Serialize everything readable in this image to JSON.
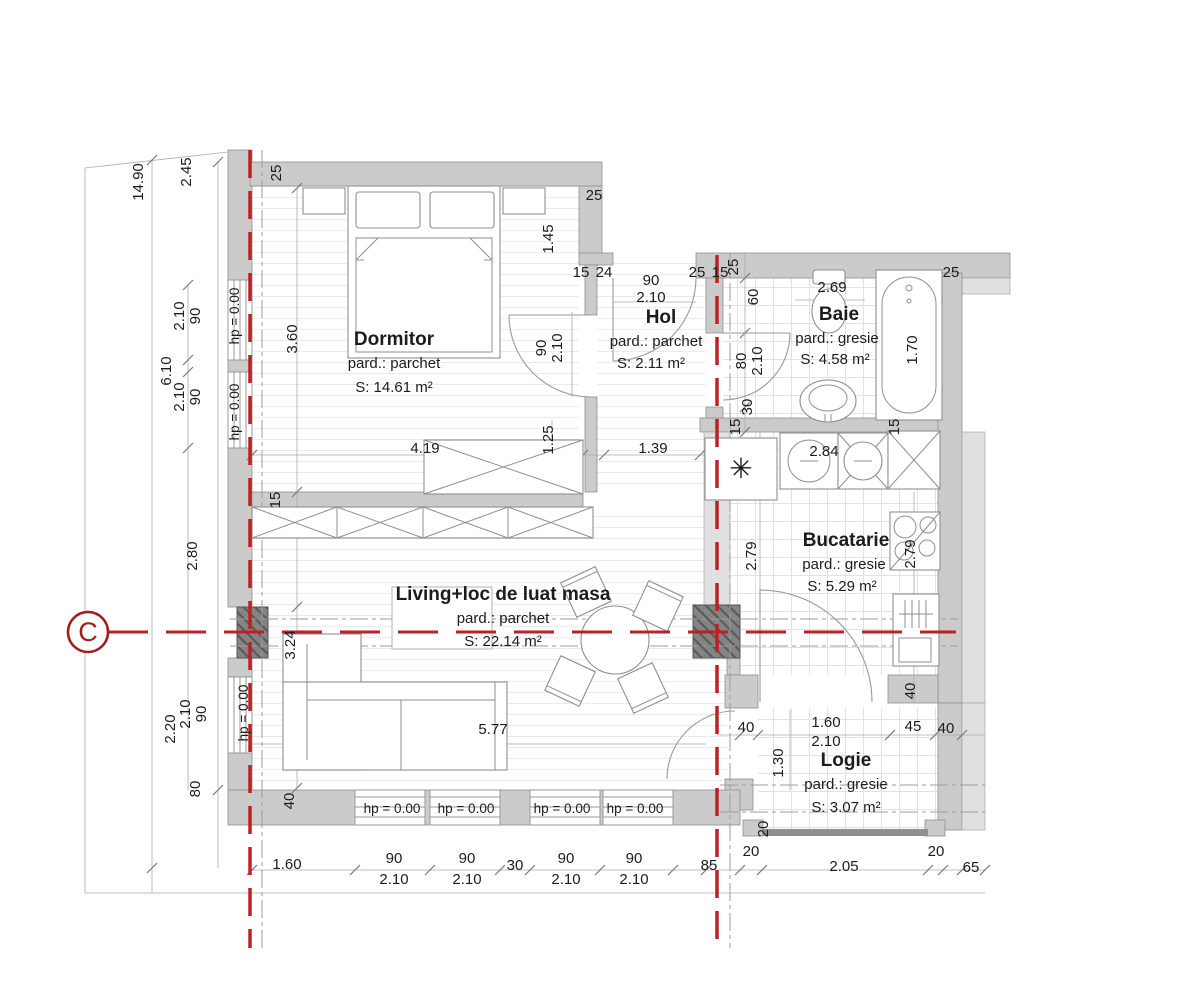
{
  "drawing": {
    "kind": "apartment-floor-plan",
    "section_marker": {
      "label": "C"
    },
    "colors": {
      "section_red": "#bf2026",
      "marker_red": "#a21d1d",
      "wall_gray": "#cbcbcb",
      "column_dark": "#848484"
    }
  },
  "rooms": [
    {
      "id": "dormitor",
      "name": "Dormitor",
      "floor": "pard.: parchet",
      "area": "S: 14.61 m²"
    },
    {
      "id": "hol",
      "name": "Hol",
      "floor": "pard.: parchet",
      "area": "S: 2.11 m²"
    },
    {
      "id": "baie",
      "name": "Baie",
      "floor": "pard.: gresie",
      "area": "S: 4.58 m²"
    },
    {
      "id": "bucatarie",
      "name": "Bucatarie",
      "floor": "pard.: gresie",
      "area": "S: 5.29 m²"
    },
    {
      "id": "living",
      "name": "Living+loc de luat masa",
      "floor": "pard.: parchet",
      "area": "S: 22.14 m²"
    },
    {
      "id": "logie",
      "name": "Logie",
      "floor": "pard.: gresie",
      "area": "S: 3.07 m²"
    }
  ],
  "dimensions": [
    {
      "t": "14.90",
      "x": 143,
      "y": 182,
      "r": -90
    },
    {
      "t": "2.45",
      "x": 191,
      "y": 172,
      "r": -90
    },
    {
      "t": "90",
      "x": 200,
      "y": 316,
      "r": -90
    },
    {
      "t": "2.10",
      "x": 184,
      "y": 316,
      "r": -90
    },
    {
      "t": "hp = 0.00",
      "x": 239,
      "y": 316,
      "r": -90,
      "s": true
    },
    {
      "t": "6.10",
      "x": 171,
      "y": 371,
      "r": -90
    },
    {
      "t": "90",
      "x": 200,
      "y": 397,
      "r": -90
    },
    {
      "t": "2.10",
      "x": 184,
      "y": 397,
      "r": -90
    },
    {
      "t": "hp = 0.00",
      "x": 239,
      "y": 412,
      "r": -90,
      "s": true
    },
    {
      "t": "2.80",
      "x": 197,
      "y": 556,
      "r": -90
    },
    {
      "t": "90",
      "x": 206,
      "y": 714,
      "r": -90
    },
    {
      "t": "2.10",
      "x": 190,
      "y": 714,
      "r": -90
    },
    {
      "t": "2.20",
      "x": 175,
      "y": 729,
      "r": -90
    },
    {
      "t": "hp = 0.00",
      "x": 248,
      "y": 713,
      "r": -90,
      "s": true
    },
    {
      "t": "80",
      "x": 200,
      "y": 789,
      "r": -90
    },
    {
      "t": "25",
      "x": 281,
      "y": 173,
      "r": -90
    },
    {
      "t": "3.60",
      "x": 297,
      "y": 339,
      "r": -90
    },
    {
      "t": "15",
      "x": 280,
      "y": 500,
      "r": -90
    },
    {
      "t": "3.24",
      "x": 295,
      "y": 645,
      "r": -90
    },
    {
      "t": "40",
      "x": 294,
      "y": 801,
      "r": -90
    },
    {
      "t": "25",
      "x": 594,
      "y": 200
    },
    {
      "t": "1.45",
      "x": 553,
      "y": 239,
      "r": -90
    },
    {
      "t": "15",
      "x": 581,
      "y": 277
    },
    {
      "t": "24",
      "x": 604,
      "y": 277
    },
    {
      "t": "90",
      "x": 651,
      "y": 285
    },
    {
      "t": "2.10",
      "x": 651,
      "y": 302
    },
    {
      "t": "25",
      "x": 697,
      "y": 277
    },
    {
      "t": "15",
      "x": 720,
      "y": 277
    },
    {
      "t": "25",
      "x": 738,
      "y": 267,
      "r": -90
    },
    {
      "t": "60",
      "x": 758,
      "y": 297,
      "r": -90
    },
    {
      "t": "80",
      "x": 746,
      "y": 361,
      "r": -90
    },
    {
      "t": "2.10",
      "x": 762,
      "y": 361,
      "r": -90
    },
    {
      "t": "30",
      "x": 752,
      "y": 407,
      "r": -90
    },
    {
      "t": "15",
      "x": 740,
      "y": 427,
      "r": -90
    },
    {
      "t": "2.69",
      "x": 832,
      "y": 292
    },
    {
      "t": "1.70",
      "x": 917,
      "y": 350,
      "r": -90
    },
    {
      "t": "25",
      "x": 951,
      "y": 277
    },
    {
      "t": "15",
      "x": 899,
      "y": 427,
      "r": -90
    },
    {
      "t": "90",
      "x": 546,
      "y": 348,
      "r": -90
    },
    {
      "t": "2.10",
      "x": 562,
      "y": 348,
      "r": -90
    },
    {
      "t": "4.19",
      "x": 425,
      "y": 453
    },
    {
      "t": "1.25",
      "x": 553,
      "y": 440,
      "r": -90
    },
    {
      "t": "1.39",
      "x": 653,
      "y": 453
    },
    {
      "t": "2.84",
      "x": 824,
      "y": 456
    },
    {
      "t": "2.79",
      "x": 756,
      "y": 556,
      "r": -90
    },
    {
      "t": "2.79",
      "x": 915,
      "y": 554,
      "r": -90
    },
    {
      "t": "40",
      "x": 915,
      "y": 691,
      "r": -90
    },
    {
      "t": "5.77",
      "x": 493,
      "y": 734
    },
    {
      "t": "40",
      "x": 746,
      "y": 732
    },
    {
      "t": "1.60",
      "x": 826,
      "y": 727
    },
    {
      "t": "2.10",
      "x": 826,
      "y": 746
    },
    {
      "t": "45",
      "x": 913,
      "y": 731
    },
    {
      "t": "40",
      "x": 946,
      "y": 733
    },
    {
      "t": "1.30",
      "x": 783,
      "y": 763,
      "r": -90
    },
    {
      "t": "20",
      "x": 768,
      "y": 829,
      "r": -90
    },
    {
      "t": "hp = 0.00",
      "x": 392,
      "y": 813,
      "s": true
    },
    {
      "t": "hp = 0.00",
      "x": 466,
      "y": 813,
      "s": true
    },
    {
      "t": "hp = 0.00",
      "x": 562,
      "y": 813,
      "s": true
    },
    {
      "t": "hp = 0.00",
      "x": 635,
      "y": 813,
      "s": true
    },
    {
      "t": "1.60",
      "x": 287,
      "y": 869
    },
    {
      "t": "90",
      "x": 394,
      "y": 863
    },
    {
      "t": "2.10",
      "x": 394,
      "y": 884
    },
    {
      "t": "90",
      "x": 467,
      "y": 863
    },
    {
      "t": "2.10",
      "x": 467,
      "y": 884
    },
    {
      "t": "30",
      "x": 515,
      "y": 870
    },
    {
      "t": "90",
      "x": 566,
      "y": 863
    },
    {
      "t": "2.10",
      "x": 566,
      "y": 884
    },
    {
      "t": "90",
      "x": 634,
      "y": 863
    },
    {
      "t": "2.10",
      "x": 634,
      "y": 884
    },
    {
      "t": "85",
      "x": 709,
      "y": 870
    },
    {
      "t": "20",
      "x": 751,
      "y": 856
    },
    {
      "t": "2.05",
      "x": 844,
      "y": 871
    },
    {
      "t": "20",
      "x": 936,
      "y": 856
    },
    {
      "t": "65",
      "x": 971,
      "y": 872
    }
  ]
}
